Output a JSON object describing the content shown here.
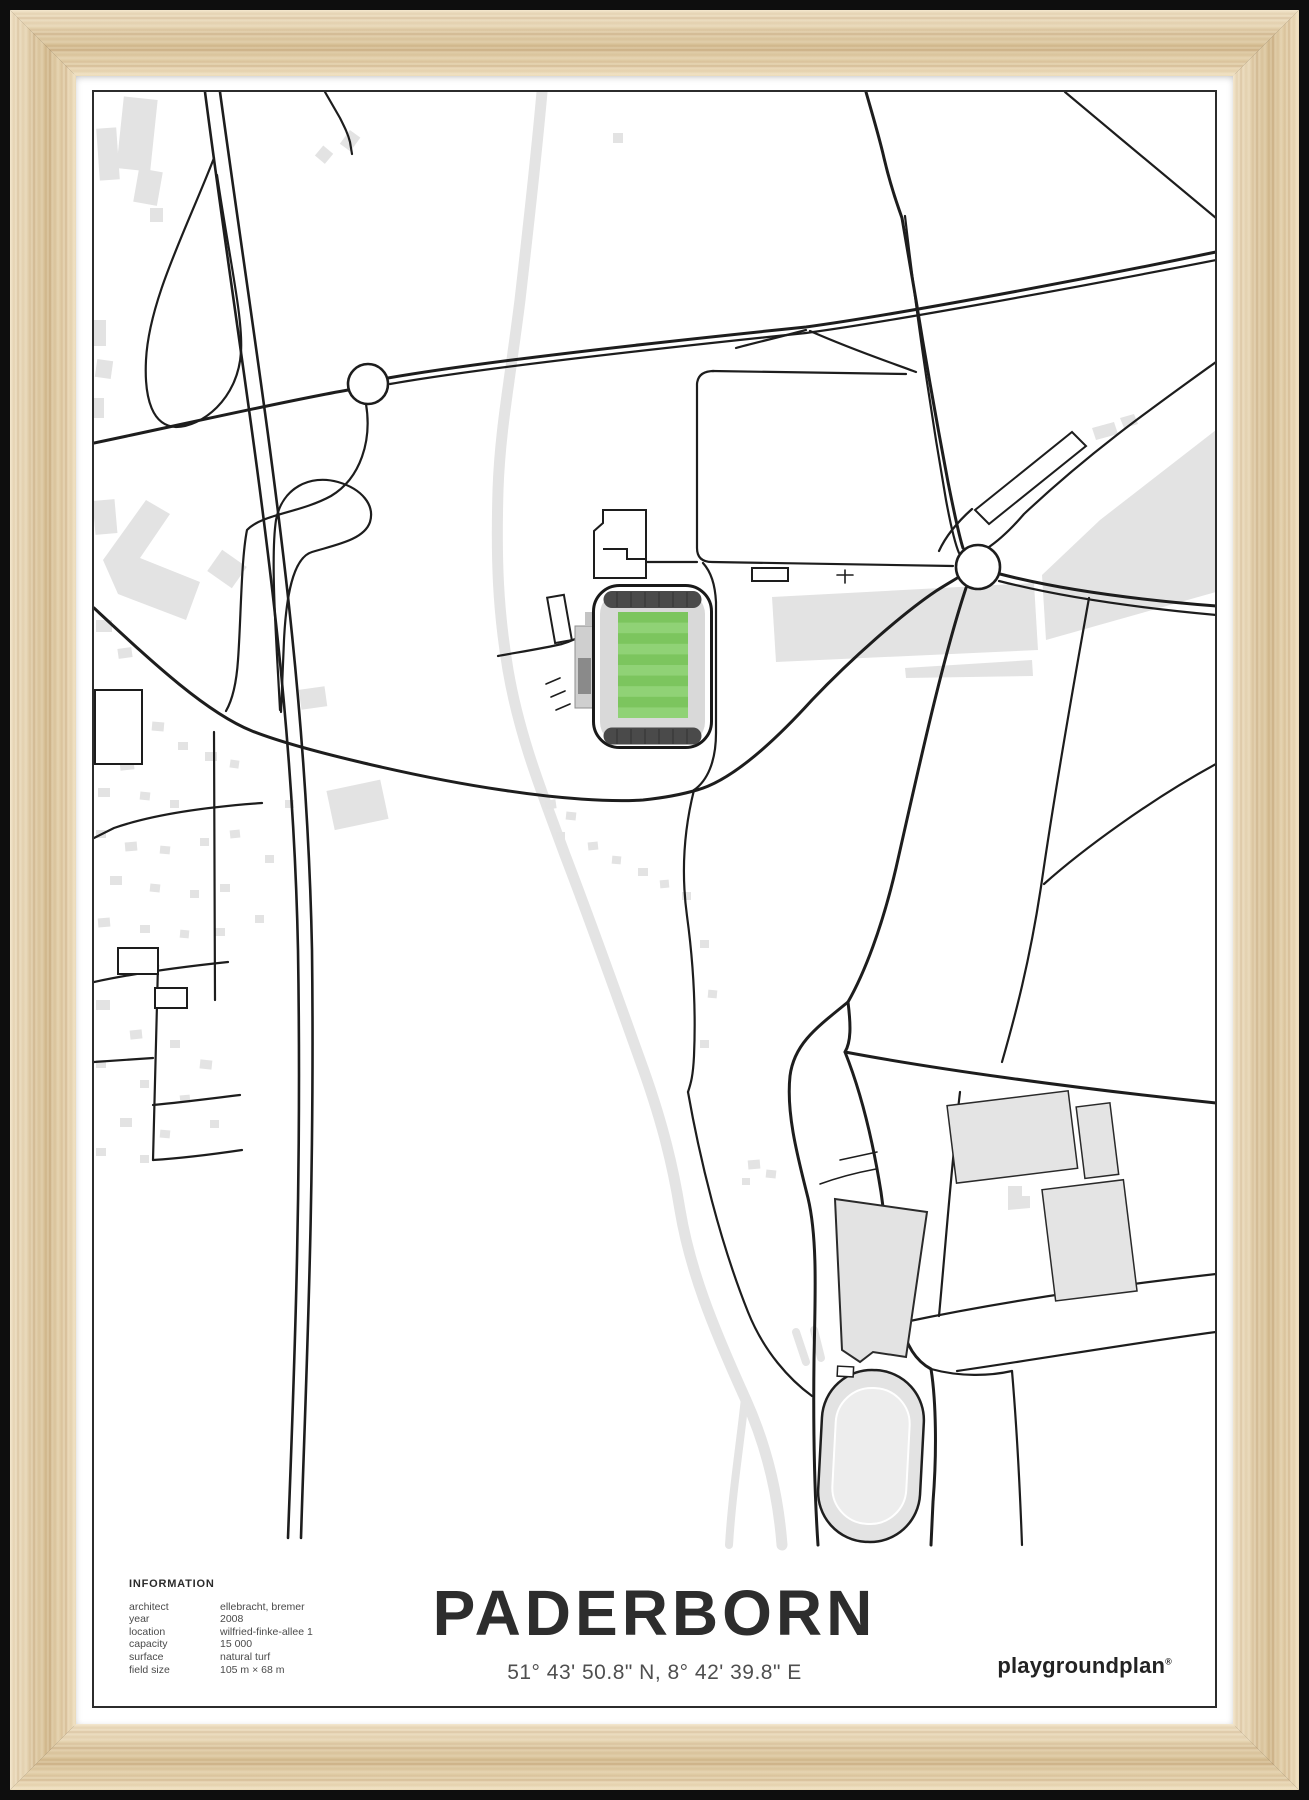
{
  "poster": {
    "title": "PADERBORN",
    "coordinates": "51° 43' 50.8\" N, 8° 42' 39.8\" E",
    "brand": {
      "name": "playgroundplan",
      "mark": "®"
    },
    "information": {
      "heading": "INFORMATION",
      "rows": [
        {
          "label": "architect",
          "value": "ellebracht, bremer"
        },
        {
          "label": "year",
          "value": "2008"
        },
        {
          "label": "location",
          "value": "wilfried-finke-allee 1"
        },
        {
          "label": "capacity",
          "value": "15 000"
        },
        {
          "label": "surface",
          "value": "natural turf"
        },
        {
          "label": "field size",
          "value": "105 m × 68 m"
        }
      ]
    }
  },
  "colors": {
    "pitch_green": "#7cc55e",
    "pitch_green_light": "#90d276",
    "stadium_roof": "#4a4a4a",
    "stadium_stand": "#d9d9d9",
    "building_gray": "#e3e3e3",
    "road_black": "#1d1d1d",
    "river_gray": "#e4e4e4",
    "border_dark": "#2c2c2c",
    "wood_light": "#ecd9b4",
    "wood_dark": "#c9a878",
    "text_dark": "#2d2d2d",
    "text_gray": "#4a4a4a"
  }
}
